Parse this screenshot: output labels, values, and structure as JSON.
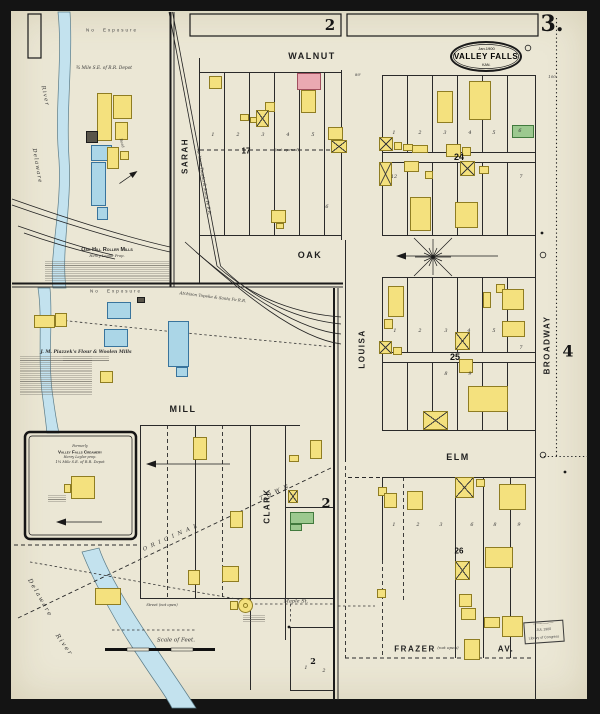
{
  "palette": {
    "paper": "#ebe7d5",
    "ink": "#2a2a2a",
    "river": "#c3e2ee",
    "y": {
      "f": "#f4e17e",
      "l": "#8f7d22"
    },
    "p": {
      "f": "#eaa9b2",
      "l": "#a14f5e"
    },
    "b": {
      "f": "#abd6e7",
      "l": "#39749c"
    },
    "g": {
      "f": "#9cc98f",
      "l": "#417a3d"
    },
    "d": {
      "f": "#59554a",
      "l": "#1c1c1c"
    }
  },
  "sheet": {
    "number": "3.",
    "adjacent_top": "2",
    "adjacent_mid": "2",
    "adjacent_right": "4"
  },
  "title": {
    "date": "Jan.1900",
    "city": "VALLEY FALLS",
    "state": "KAN."
  },
  "streets": {
    "walnut": "WALNUT",
    "oak": "OAK",
    "elm": "ELM",
    "mill": "MILL",
    "sarah": "SARAH",
    "clark": "CLARK",
    "louisa": "LOUISA",
    "broadway": "BROADWAY",
    "frazer": "FRAZER",
    "frazer_av": "AV.",
    "frazer_note": "(not open)",
    "maple": "Maple St."
  },
  "blocks": {
    "b17": "17",
    "b17_note": "(not opened)",
    "b24": "24",
    "b25": "25",
    "b26": "26",
    "b2": "2"
  },
  "river_labels": {
    "delaware": "Delaware",
    "river": "River"
  },
  "mills": {
    "oak_hill": "Oak Hill Roller Mills",
    "oak_hill_prop": "Henry Leglar Prop.",
    "piazzek": "J. M. Piazzek's Flour & Woolen Mills"
  },
  "creamery": {
    "l1": "Formerly",
    "l2": "Valley Falls Creamery",
    "l3": "Henry Leglar prop.",
    "l4": "1¼ Mile S.E. of R.R. Depot"
  },
  "railroad": "Atchison Topeka & Santa Fe R.R.",
  "notes": {
    "no_exposure": "No Exposure",
    "depot_a": "¾ Mile S.E. of R.R. Depot",
    "scale": "Scale of Feet.",
    "street_not_open": "Street (not open)",
    "road": "Road",
    "town1": "ORIGINAL",
    "town2": "TOWN"
  },
  "stamp": {
    "l1": "JUL 1900",
    "l2": "Library of Congress"
  },
  "ticks": [
    {
      "t": "80'",
      "x": 358,
      "y": 75
    },
    {
      "t": "100",
      "x": 552,
      "y": 77
    }
  ],
  "lot_numbers": [
    {
      "t": "1",
      "x": 213,
      "y": 135
    },
    {
      "t": "2",
      "x": 238,
      "y": 135
    },
    {
      "t": "3",
      "x": 263,
      "y": 135
    },
    {
      "t": "4",
      "x": 288,
      "y": 135
    },
    {
      "t": "5",
      "x": 313,
      "y": 135
    },
    {
      "t": "6",
      "x": 327,
      "y": 207
    },
    {
      "t": "1",
      "x": 394,
      "y": 133
    },
    {
      "t": "2",
      "x": 420,
      "y": 133
    },
    {
      "t": "3",
      "x": 445,
      "y": 133
    },
    {
      "t": "4",
      "x": 470,
      "y": 133
    },
    {
      "t": "5",
      "x": 494,
      "y": 133
    },
    {
      "t": "6",
      "x": 520,
      "y": 131
    },
    {
      "t": "12",
      "x": 394,
      "y": 177
    },
    {
      "t": "7",
      "x": 521,
      "y": 177
    },
    {
      "t": "1",
      "x": 395,
      "y": 331
    },
    {
      "t": "2",
      "x": 420,
      "y": 331
    },
    {
      "t": "3",
      "x": 446,
      "y": 331
    },
    {
      "t": "4",
      "x": 469,
      "y": 331
    },
    {
      "t": "5",
      "x": 494,
      "y": 331
    },
    {
      "t": "7",
      "x": 521,
      "y": 348
    },
    {
      "t": "8",
      "x": 446,
      "y": 374
    },
    {
      "t": "9",
      "x": 470,
      "y": 374
    },
    {
      "t": "1",
      "x": 394,
      "y": 525
    },
    {
      "t": "2",
      "x": 418,
      "y": 525
    },
    {
      "t": "3",
      "x": 441,
      "y": 525
    },
    {
      "t": "6",
      "x": 472,
      "y": 525
    },
    {
      "t": "8",
      "x": 495,
      "y": 525
    },
    {
      "t": "9",
      "x": 519,
      "y": 525
    },
    {
      "t": "1",
      "x": 306,
      "y": 668
    },
    {
      "t": "2",
      "x": 324,
      "y": 671
    }
  ],
  "buildings": [
    [
      97,
      93,
      15,
      48,
      "y"
    ],
    [
      113,
      95,
      19,
      24,
      "y"
    ],
    [
      115,
      122,
      13,
      18,
      "y"
    ],
    [
      86,
      131,
      12,
      12,
      "d"
    ],
    [
      91,
      145,
      21,
      16,
      "b"
    ],
    [
      91,
      162,
      15,
      44,
      "b"
    ],
    [
      107,
      147,
      12,
      22,
      "y"
    ],
    [
      97,
      207,
      11,
      13,
      "b"
    ],
    [
      120,
      151,
      9,
      9,
      "y"
    ],
    [
      34,
      315,
      21,
      13,
      "y"
    ],
    [
      55,
      313,
      12,
      14,
      "y"
    ],
    [
      107,
      302,
      24,
      17,
      "b"
    ],
    [
      104,
      329,
      24,
      18,
      "b"
    ],
    [
      137,
      297,
      8,
      6,
      "d"
    ],
    [
      100,
      371,
      13,
      12,
      "y"
    ],
    [
      168,
      321,
      21,
      46,
      "b"
    ],
    [
      176,
      367,
      12,
      10,
      "b"
    ],
    [
      193,
      437,
      14,
      23,
      "y"
    ],
    [
      230,
      511,
      13,
      17,
      "y"
    ],
    [
      290,
      512,
      24,
      12,
      "g"
    ],
    [
      290,
      524,
      12,
      7,
      "g"
    ],
    [
      310,
      440,
      12,
      19,
      "y"
    ],
    [
      289,
      455,
      10,
      7,
      "y"
    ],
    [
      288,
      490,
      10,
      13,
      "y",
      "x"
    ],
    [
      188,
      570,
      12,
      15,
      "y"
    ],
    [
      222,
      566,
      17,
      16,
      "y"
    ],
    [
      95,
      588,
      26,
      17,
      "y"
    ],
    [
      238,
      598,
      15,
      15,
      "y",
      "r"
    ],
    [
      243,
      603,
      5,
      5,
      "y",
      "r"
    ],
    [
      230,
      601,
      8,
      9,
      "y"
    ],
    [
      71,
      476,
      24,
      23,
      "y"
    ],
    [
      64,
      484,
      7,
      9,
      "y"
    ],
    [
      209,
      76,
      13,
      13,
      "y"
    ],
    [
      297,
      73,
      24,
      17,
      "p"
    ],
    [
      301,
      90,
      15,
      23,
      "y"
    ],
    [
      265,
      102,
      10,
      10,
      "y"
    ],
    [
      256,
      110,
      13,
      17,
      "y",
      "x"
    ],
    [
      240,
      114,
      9,
      7,
      "y"
    ],
    [
      250,
      117,
      7,
      6,
      "y"
    ],
    [
      328,
      127,
      15,
      13,
      "y"
    ],
    [
      331,
      140,
      16,
      13,
      "y",
      "x"
    ],
    [
      271,
      210,
      15,
      13,
      "y"
    ],
    [
      276,
      223,
      8,
      6,
      "y"
    ],
    [
      437,
      91,
      16,
      32,
      "y"
    ],
    [
      469,
      81,
      22,
      39,
      "y"
    ],
    [
      512,
      125,
      22,
      13,
      "g"
    ],
    [
      379,
      137,
      14,
      14,
      "y",
      "x"
    ],
    [
      394,
      142,
      8,
      8,
      "y"
    ],
    [
      403,
      144,
      10,
      7,
      "y"
    ],
    [
      412,
      145,
      16,
      8,
      "y"
    ],
    [
      446,
      144,
      15,
      13,
      "y"
    ],
    [
      462,
      147,
      9,
      9,
      "y"
    ],
    [
      379,
      162,
      13,
      24,
      "y",
      "x"
    ],
    [
      404,
      161,
      15,
      11,
      "y"
    ],
    [
      460,
      161,
      15,
      15,
      "y",
      "x"
    ],
    [
      479,
      166,
      10,
      8,
      "y"
    ],
    [
      425,
      171,
      8,
      8,
      "y"
    ],
    [
      410,
      197,
      21,
      34,
      "y"
    ],
    [
      455,
      202,
      23,
      26,
      "y"
    ],
    [
      388,
      286,
      16,
      31,
      "y"
    ],
    [
      384,
      319,
      9,
      10,
      "y"
    ],
    [
      379,
      341,
      13,
      13,
      "y",
      "x"
    ],
    [
      393,
      347,
      9,
      8,
      "y"
    ],
    [
      496,
      284,
      9,
      9,
      "y"
    ],
    [
      502,
      289,
      22,
      21,
      "y"
    ],
    [
      483,
      292,
      8,
      16,
      "y"
    ],
    [
      502,
      321,
      23,
      16,
      "y"
    ],
    [
      455,
      332,
      15,
      18,
      "y",
      "x"
    ],
    [
      459,
      359,
      14,
      14,
      "y"
    ],
    [
      468,
      386,
      40,
      26,
      "y"
    ],
    [
      423,
      411,
      25,
      19,
      "y",
      "x"
    ],
    [
      455,
      477,
      19,
      21,
      "y",
      "x"
    ],
    [
      476,
      479,
      9,
      8,
      "y"
    ],
    [
      499,
      484,
      27,
      26,
      "y"
    ],
    [
      378,
      487,
      9,
      9,
      "y"
    ],
    [
      384,
      493,
      13,
      15,
      "y"
    ],
    [
      407,
      491,
      16,
      19,
      "y"
    ],
    [
      485,
      547,
      28,
      21,
      "y"
    ],
    [
      455,
      561,
      15,
      19,
      "y",
      "x"
    ],
    [
      459,
      594,
      13,
      13,
      "y"
    ],
    [
      461,
      608,
      15,
      12,
      "y"
    ],
    [
      484,
      617,
      16,
      11,
      "y"
    ],
    [
      502,
      616,
      21,
      21,
      "y"
    ],
    [
      464,
      639,
      16,
      21,
      "y"
    ],
    [
      377,
      589,
      9,
      9,
      "y"
    ]
  ]
}
